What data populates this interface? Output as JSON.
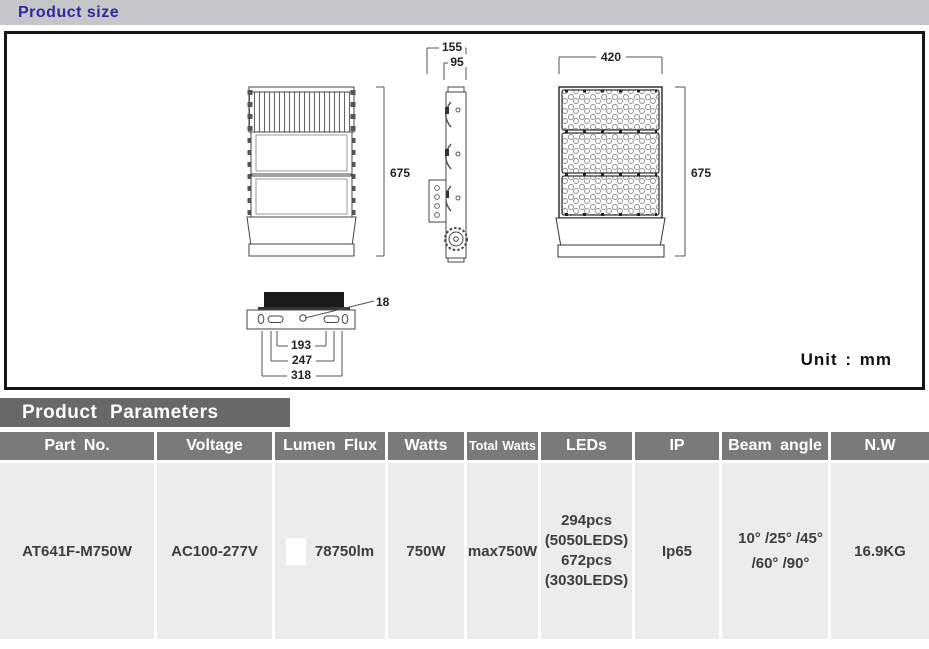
{
  "page": {
    "header_title": "Product size",
    "params_title": "Product Parameters",
    "unit_label": "Unit : mm"
  },
  "drawing": {
    "dims": {
      "back_height": "675",
      "front_height": "675",
      "front_width": "420",
      "side_depth_total": "155",
      "side_depth_body": "95",
      "mount_hole": "18",
      "mount_span_inner": "193",
      "mount_span_mid": "247",
      "mount_span_outer": "318"
    }
  },
  "table": {
    "columns": [
      "Part No.",
      "Voltage",
      "Lumen Flux",
      "Watts",
      "Total Watts",
      "LEDs",
      "IP",
      "Beam angle",
      "N.W"
    ],
    "row": {
      "part_no": "AT641F-M750W",
      "voltage": "AC100-277V",
      "lumen_flux": "78750lm",
      "watts": "750W",
      "total_watts": "max750W",
      "leds": "294pcs\n(5050LEDS)\n672pcs\n(3030LEDS)",
      "ip": "Ip65",
      "beam_angle": "10° /25° /45°\n/60° /90°",
      "net_weight": "16.9KG"
    }
  },
  "colors": {
    "accent_blue": "#2b2b9b",
    "topbar_gray": "#c6c6ca",
    "params_bar_gray": "#686868",
    "table_header_gray": "#7a7a7a",
    "table_row_gray": "#ececec",
    "box_border": "#161616"
  }
}
